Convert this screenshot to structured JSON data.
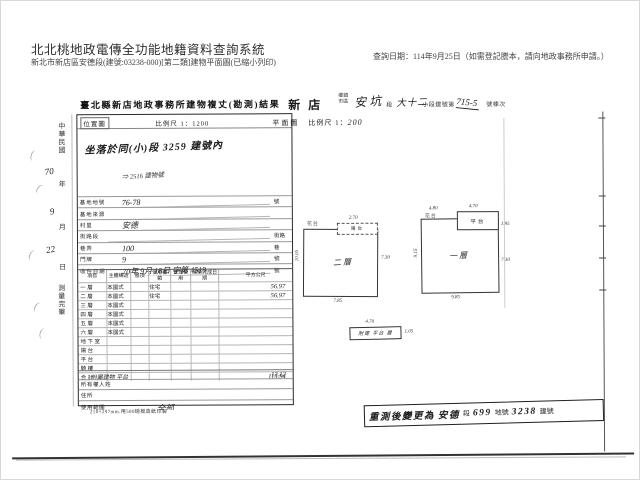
{
  "header": {
    "system_title": "北北桃地政電傳全功能地籍資料查詢系統",
    "document_line": "新北市新店區安德段(建號:03238-000)[第二類]建物平面圖(已縮小列印)",
    "query_date": "查詢日期：114年9月25日（如需登記謄本，請向地政事務所申請。）"
  },
  "survey": {
    "title": "臺北縣新店地政事務所建物複丈(勘測)結果",
    "date_margin": {
      "era": "中華民國",
      "year": "70",
      "year_label": "年",
      "month": "9",
      "month_label": "月",
      "day": "22",
      "day_label": "日",
      "footer": "測量完畢"
    },
    "location_map": {
      "label": "位置圖",
      "scale": "比例尺 1：1200",
      "note_line1": "坐落於同(小)段 3259 建號內",
      "note_line2": "⇒ 2516 建物號"
    },
    "info_rows": [
      {
        "label": "基地地號",
        "value": "76-78",
        "suffix": "號"
      },
      {
        "label": "基地來源",
        "value": "",
        "suffix": ""
      },
      {
        "label": "村里",
        "value": "安德",
        "suffix": ""
      },
      {
        "label": "街路段",
        "value": "",
        "suffix": "街路"
      },
      {
        "label": "巷弄",
        "value": "100",
        "suffix": "巷"
      },
      {
        "label": "門牌",
        "value": "9",
        "suffix": "號"
      },
      {
        "label": "收件日期",
        "value": "70年 9月 18日 字第 4519",
        "suffix": "號"
      }
    ],
    "area_table": {
      "header": [
        "項目",
        "主體構造",
        "屋頂",
        "使用種類",
        "管理使用",
        "建築完成日期",
        "平方公尺"
      ],
      "rows": [
        {
          "label": "一層",
          "structure": "本國式",
          "use": "住宅",
          "area": "56.97"
        },
        {
          "label": "二層",
          "structure": "本國式",
          "use": "住宅",
          "area": "56.97"
        },
        {
          "label": "三層",
          "structure": "本國式",
          "use": "",
          "area": ""
        },
        {
          "label": "四層",
          "structure": "本國式",
          "use": "",
          "area": ""
        },
        {
          "label": "五層",
          "structure": "本國式",
          "use": "",
          "area": ""
        },
        {
          "label": "六層",
          "structure": "本國式",
          "use": "",
          "area": ""
        },
        {
          "label": "地下室",
          "structure": "",
          "use": "",
          "area": ""
        },
        {
          "label": "陽台",
          "structure": "",
          "use": "",
          "area": ""
        },
        {
          "label": "平台",
          "structure": "",
          "use": "",
          "area": ""
        },
        {
          "label": "騎樓",
          "structure": "",
          "use": "",
          "area": ""
        },
        {
          "label": "合計",
          "structure": "",
          "use": "",
          "area": "113.94"
        }
      ],
      "attached_note": {
        "text": "附屬建物 平台",
        "area": "12.12"
      }
    },
    "owner_rows": [
      {
        "label": "所有權人姓名",
        "value": ""
      },
      {
        "label": "住所",
        "value": ""
      },
      {
        "label": "使用範圍",
        "value": "全部"
      }
    ],
    "print_note": "210×297mm.用500磅模造紙印製"
  },
  "plan": {
    "header": {
      "town": "新店",
      "town_label": "鄉鎮市區",
      "section": "安坑",
      "section_label": "段",
      "subsection": "大十二",
      "subsection_label": "小段建號第",
      "building_no": "715-5",
      "building_no_label": "號棟次"
    },
    "label": "平面圖",
    "scale_label": "比例尺 1：",
    "scale_value": "200",
    "floors": [
      {
        "name": "二層",
        "annex_label": "陽台",
        "scribble": "花台",
        "dim_left": "10.05",
        "dim_right": "7.30",
        "dim_bottom": "7.85",
        "dim_annex": "2.70"
      },
      {
        "name": "一層",
        "annex_label": "平台",
        "scribble": "花台",
        "dim_left": "9.15",
        "dim_right": "7.30",
        "dim_bottom": "9.85",
        "dim_annex": "4.70",
        "dim_annex_right": "1.95",
        "dim_top": "4.80"
      }
    ],
    "annex_detail": {
      "label": "附建 平台 層",
      "dim_top": "4.70",
      "dim_right": "1.05"
    },
    "stamp": {
      "prefix": "重測後變更為",
      "section": "安德",
      "section_label": "段",
      "parcel": "699",
      "parcel_label": "地號",
      "building": "3238",
      "building_label": "建號"
    }
  }
}
